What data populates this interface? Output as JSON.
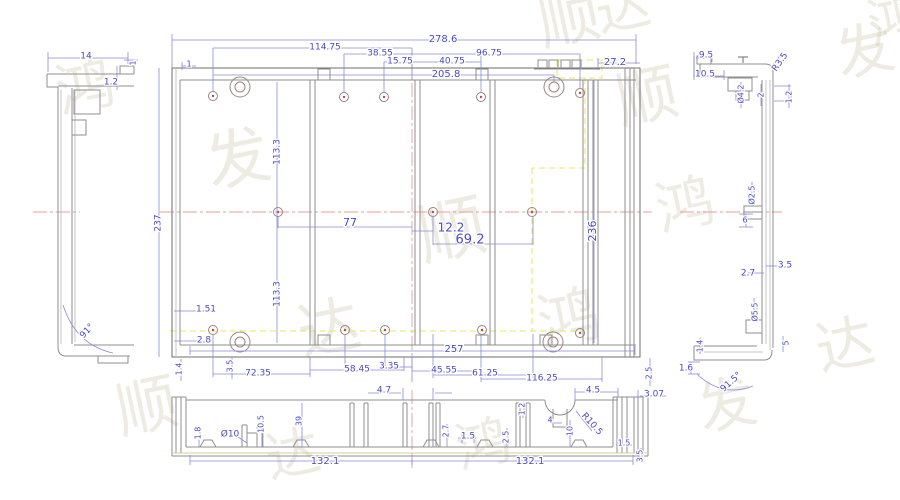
{
  "drawing": {
    "type": "engineering-cad-drawing",
    "subject": "aluminium enclosure extrusion, multi-view dimensioned drawing",
    "views": [
      "left-profile",
      "main-plan",
      "right-profile",
      "bottom-section"
    ]
  },
  "colors": {
    "dimension": "#4a4ac2",
    "geometry": "#8f8f8f",
    "centerline": "#e59c9c",
    "highlight_yellow": "#e9e45e",
    "hole_accent": "#b05050",
    "watermark": "#c9bfa4",
    "background": "#ffffff"
  },
  "dimension_labels": [
    {
      "view": "main",
      "t": "278.6",
      "x": 443,
      "y": 39,
      "size": 10
    },
    {
      "view": "main",
      "t": "114.75",
      "x": 325,
      "y": 47
    },
    {
      "view": "main",
      "t": "38.55",
      "x": 380,
      "y": 53
    },
    {
      "view": "main",
      "t": "15.75",
      "x": 400,
      "y": 61
    },
    {
      "view": "main",
      "t": "40.75",
      "x": 452,
      "y": 61
    },
    {
      "view": "main",
      "t": "96.75",
      "x": 489,
      "y": 53
    },
    {
      "view": "main",
      "t": "205.8",
      "x": 446,
      "y": 74,
      "size": 10
    },
    {
      "view": "main",
      "t": "27.2",
      "x": 615,
      "y": 62,
      "size": 10
    },
    {
      "view": "main",
      "t": "1",
      "x": 189,
      "y": 64,
      "size": 8
    },
    {
      "view": "main",
      "t": "113.3",
      "x": 277,
      "y": 152,
      "r": -90
    },
    {
      "view": "main",
      "t": "237",
      "x": 158,
      "y": 223,
      "r": -90
    },
    {
      "view": "main",
      "t": "77",
      "x": 350,
      "y": 223,
      "size": 11
    },
    {
      "view": "main",
      "t": "12.2",
      "x": 451,
      "y": 228,
      "size": 12
    },
    {
      "view": "main",
      "t": "69.2",
      "x": 470,
      "y": 240,
      "size": 13
    },
    {
      "view": "main",
      "t": "236",
      "x": 593,
      "y": 231,
      "r": -90,
      "size": 11
    },
    {
      "view": "main",
      "t": "113.3",
      "x": 277,
      "y": 294,
      "r": -90
    },
    {
      "view": "main",
      "t": "1.51",
      "x": 206,
      "y": 309
    },
    {
      "view": "main",
      "t": "2.8",
      "x": 204,
      "y": 340
    },
    {
      "view": "main",
      "t": "257",
      "x": 454,
      "y": 349,
      "size": 10
    },
    {
      "view": "main",
      "t": "72.35",
      "x": 258,
      "y": 373
    },
    {
      "view": "main",
      "t": "58.45",
      "x": 357,
      "y": 369
    },
    {
      "view": "main",
      "t": "3.35",
      "x": 389,
      "y": 366
    },
    {
      "view": "main",
      "t": "45.55",
      "x": 444,
      "y": 370
    },
    {
      "view": "main",
      "t": "61.25",
      "x": 485,
      "y": 373
    },
    {
      "view": "main",
      "t": "116.25",
      "x": 542,
      "y": 378
    },
    {
      "view": "main",
      "t": "1.4",
      "x": 179,
      "y": 369,
      "r": -90,
      "size": 8
    },
    {
      "view": "main",
      "t": "3.5",
      "x": 230,
      "y": 366,
      "r": -90,
      "size": 8
    },
    {
      "view": "main",
      "t": "2.5",
      "x": 649,
      "y": 373,
      "r": -90,
      "size": 8
    },
    {
      "view": "left",
      "t": "14",
      "x": 86,
      "y": 56
    },
    {
      "view": "left",
      "t": "1",
      "x": 133,
      "y": 63,
      "r": -90,
      "size": 8
    },
    {
      "view": "left",
      "t": "1.2",
      "x": 111,
      "y": 82
    },
    {
      "view": "left",
      "t": "91°",
      "x": 87,
      "y": 331,
      "r": -48
    },
    {
      "view": "right",
      "t": "9.5",
      "x": 706,
      "y": 55
    },
    {
      "view": "right",
      "t": "10.5",
      "x": 705,
      "y": 74
    },
    {
      "view": "right",
      "t": "R3.5",
      "x": 780,
      "y": 62,
      "r": -55
    },
    {
      "view": "right",
      "t": "Ø4.2",
      "x": 741,
      "y": 94,
      "r": -90,
      "size": 8
    },
    {
      "view": "right",
      "t": "2",
      "x": 761,
      "y": 95,
      "r": -90,
      "size": 8
    },
    {
      "view": "right",
      "t": "1.2",
      "x": 789,
      "y": 97,
      "r": -90,
      "size": 8
    },
    {
      "view": "right",
      "t": "Ø2.5",
      "x": 752,
      "y": 195,
      "r": -90,
      "size": 8
    },
    {
      "view": "right",
      "t": "6",
      "x": 745,
      "y": 220,
      "size": 8
    },
    {
      "view": "right",
      "t": "3.5",
      "x": 785,
      "y": 265
    },
    {
      "view": "right",
      "t": "2.7",
      "x": 748,
      "y": 273
    },
    {
      "view": "right",
      "t": "Ø5.5",
      "x": 755,
      "y": 312,
      "r": -90,
      "size": 8
    },
    {
      "view": "right",
      "t": "1.4",
      "x": 700,
      "y": 346,
      "r": -90,
      "size": 8
    },
    {
      "view": "right",
      "t": "5",
      "x": 786,
      "y": 343,
      "r": -90,
      "size": 8
    },
    {
      "view": "right",
      "t": "1.6",
      "x": 686,
      "y": 368
    },
    {
      "view": "right",
      "t": "91.5°",
      "x": 731,
      "y": 382,
      "r": -42
    },
    {
      "view": "bottom",
      "t": "4.7",
      "x": 384,
      "y": 390
    },
    {
      "view": "bottom",
      "t": "4.5",
      "x": 593,
      "y": 390
    },
    {
      "view": "bottom",
      "t": "3.07",
      "x": 654,
      "y": 394
    },
    {
      "view": "bottom",
      "t": "1.8",
      "x": 198,
      "y": 433,
      "r": -90,
      "size": 8
    },
    {
      "view": "bottom",
      "t": "Ø10",
      "x": 230,
      "y": 434
    },
    {
      "view": "bottom",
      "t": "10.5",
      "x": 261,
      "y": 424,
      "r": -90,
      "size": 8
    },
    {
      "view": "bottom",
      "t": "39",
      "x": 299,
      "y": 421,
      "r": -90,
      "size": 8
    },
    {
      "view": "bottom",
      "t": "2.7",
      "x": 446,
      "y": 431,
      "r": -90,
      "size": 8
    },
    {
      "view": "bottom",
      "t": "1.5",
      "x": 468,
      "y": 436
    },
    {
      "view": "bottom",
      "t": "2.5",
      "x": 506,
      "y": 437,
      "r": -90,
      "size": 8
    },
    {
      "view": "bottom",
      "t": "1.2",
      "x": 522,
      "y": 409,
      "r": -90,
      "size": 8
    },
    {
      "view": "bottom",
      "t": "4",
      "x": 550,
      "y": 420,
      "size": 8
    },
    {
      "view": "bottom",
      "t": "10",
      "x": 570,
      "y": 431,
      "r": -90,
      "size": 8
    },
    {
      "view": "bottom",
      "t": "R10.5",
      "x": 592,
      "y": 424,
      "r": 48
    },
    {
      "view": "bottom",
      "t": "1.5",
      "x": 624,
      "y": 443,
      "size": 8
    },
    {
      "view": "bottom",
      "t": "3.5",
      "x": 640,
      "y": 456,
      "r": -90,
      "size": 8
    },
    {
      "view": "bottom",
      "t": "132.1",
      "x": 325,
      "y": 461,
      "size": 10
    },
    {
      "view": "bottom",
      "t": "132.1",
      "x": 530,
      "y": 461,
      "size": 10
    }
  ],
  "watermark": {
    "glyphs": [
      {
        "ch": "顺",
        "x": 538,
        "y": -12,
        "size": 62
      },
      {
        "ch": "达",
        "x": 596,
        "y": -18,
        "size": 54
      },
      {
        "ch": "鸿",
        "x": 868,
        "y": -6,
        "size": 54
      },
      {
        "ch": "发",
        "x": 836,
        "y": 22,
        "size": 58
      },
      {
        "ch": "顺",
        "x": 616,
        "y": 66,
        "size": 62
      },
      {
        "ch": "鸿",
        "x": 56,
        "y": 58,
        "size": 58
      },
      {
        "ch": "发",
        "x": 206,
        "y": 128,
        "size": 64
      },
      {
        "ch": "顺",
        "x": 418,
        "y": 198,
        "size": 68
      },
      {
        "ch": "达",
        "x": 298,
        "y": 298,
        "size": 62
      },
      {
        "ch": "顺",
        "x": 116,
        "y": 376,
        "size": 62
      },
      {
        "ch": "鸿",
        "x": 538,
        "y": 288,
        "size": 62
      },
      {
        "ch": "发",
        "x": 698,
        "y": 376,
        "size": 58
      },
      {
        "ch": "达",
        "x": 266,
        "y": 428,
        "size": 54
      },
      {
        "ch": "鸿",
        "x": 456,
        "y": 418,
        "size": 54
      },
      {
        "ch": "达",
        "x": 816,
        "y": 316,
        "size": 58
      },
      {
        "ch": "鸿",
        "x": 656,
        "y": 176,
        "size": 58
      }
    ]
  }
}
